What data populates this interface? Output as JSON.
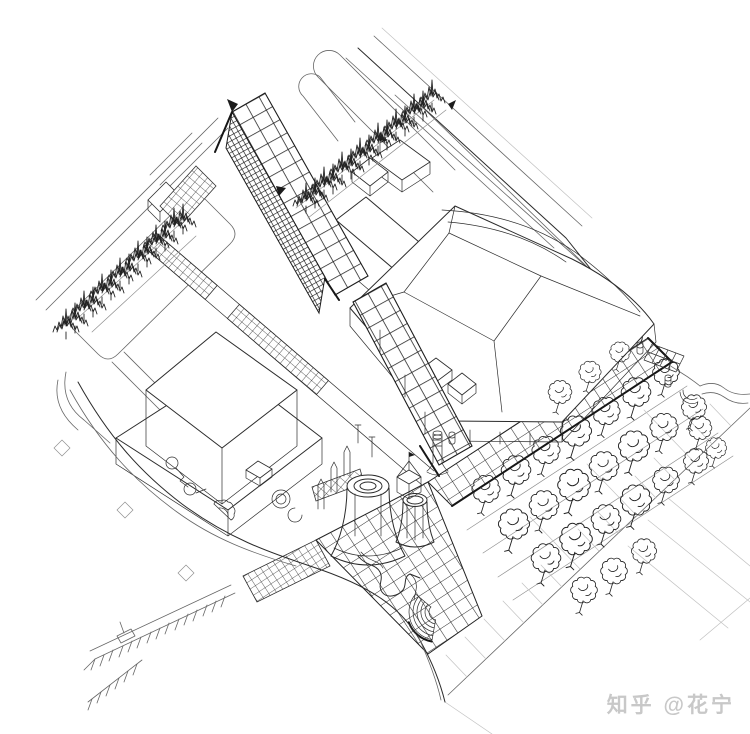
{
  "page": {
    "title": "Urban design site axonometric line drawing",
    "background": "#ffffff"
  },
  "watermark": {
    "text": "知乎 @花宁",
    "color": "#c6c6c6"
  },
  "palette": {
    "background": "#ffffff",
    "ink": "#2b2b2b",
    "ink_light": "#8f8f8f",
    "ink_faint": "#c2c2c2",
    "watermark": "#c6c6c6"
  },
  "drawing": {
    "type": "architectural axonometric bird's-eye ink line drawing of an urban plaza site",
    "elements": [
      {
        "name": "street-grid",
        "label": "Diagonal street grid with rounded-corner city blocks"
      },
      {
        "name": "concert-hall-building",
        "label": "Large faceted-roof civic building (upper right)"
      },
      {
        "name": "office-building",
        "label": "Stepped two-tier office block (left)"
      },
      {
        "name": "trellis-canopy",
        "label": "Tall diagonal grid trellis wall with pointed peak"
      },
      {
        "name": "pedestrian-bridge",
        "label": "Straight elevated walkway with checkered deck"
      },
      {
        "name": "cylindrical-towers",
        "label": "Round flared towers and pavilion at plaza center"
      },
      {
        "name": "amphitheater-steps",
        "label": "Concentric curved steps"
      },
      {
        "name": "grid-promenade",
        "label": "Gridded paved promenade band"
      },
      {
        "name": "grid-apron",
        "label": "Wide gridded plaza apron"
      },
      {
        "name": "conifer-row-upper",
        "label": "Row of conifer trees (upper center)"
      },
      {
        "name": "conifer-row-left",
        "label": "Row of conifer trees (left block)"
      },
      {
        "name": "tree-bosque",
        "label": "Bosque of round-canopy trees in diagonal rows (lower right)"
      },
      {
        "name": "curved-road",
        "label": "Sweeping curved road (bottom)"
      },
      {
        "name": "parking-lot",
        "label": "Angled parking stalls (bottom left)"
      },
      {
        "name": "plaza-follies",
        "label": "Curvilinear plaza follies and scalloped apse"
      },
      {
        "name": "paving-diamonds",
        "label": "Small diamond paving markers"
      }
    ]
  }
}
